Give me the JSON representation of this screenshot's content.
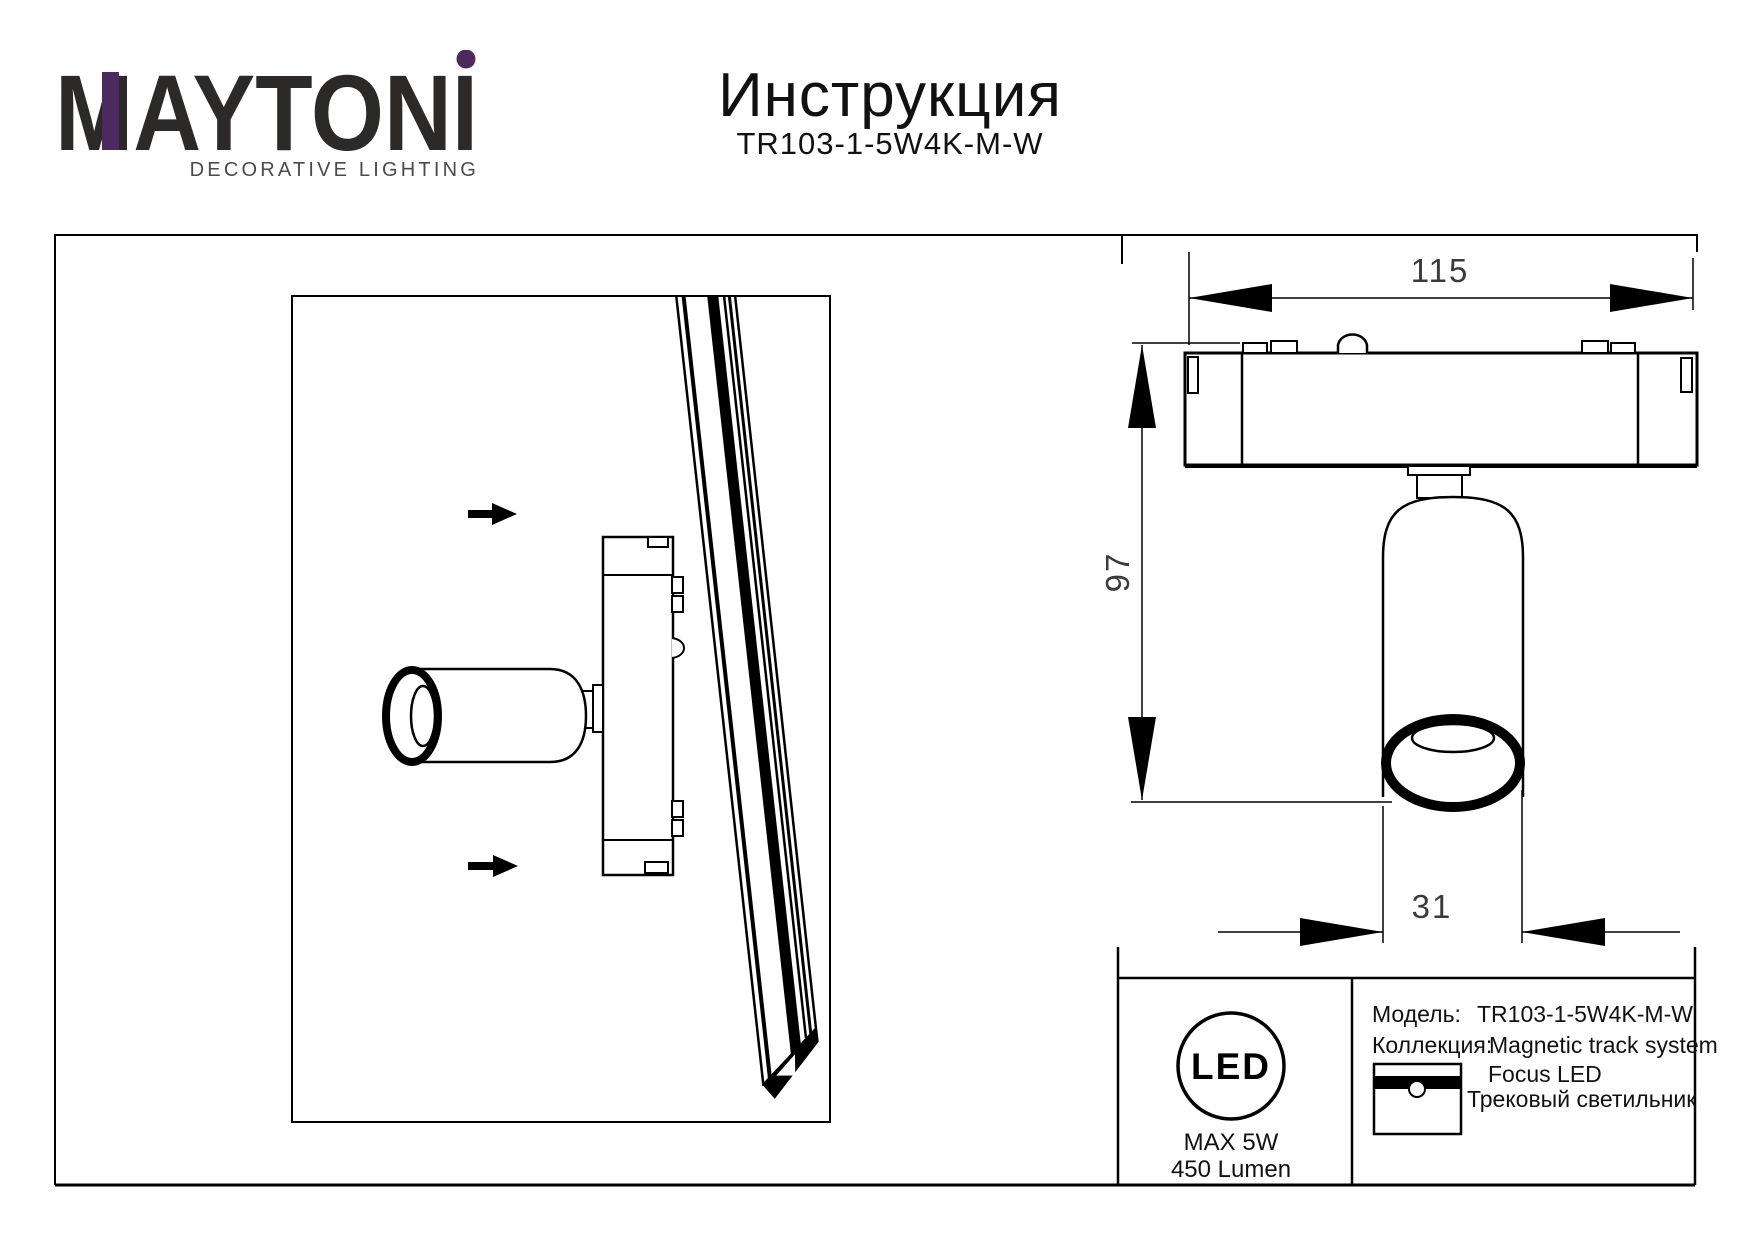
{
  "header": {
    "brand": "MAYTONI",
    "tagline": "DECORATIVE LIGHTING",
    "accent_color": "#4d2a5e",
    "title": "Инструкция",
    "model": "TR103-1-5W4K-M-W"
  },
  "drawing": {
    "dimensions": {
      "track_length": "115",
      "fixture_height": "97",
      "lamp_diameter": "31"
    }
  },
  "badge": {
    "label": "LED",
    "max_power": "MAX 5W",
    "luminous_flux": "450 Lumen",
    "icon": "led-circle-icon"
  },
  "spec_table": {
    "model_label": "Модель:",
    "model_value": "TR103-1-5W4K-M-W",
    "collection_label": "Коллекция:",
    "collection_value": "Magnetic track system",
    "product_name": "Focus LED",
    "product_type": "Трековый светильник",
    "icon": "track-light-icon"
  }
}
